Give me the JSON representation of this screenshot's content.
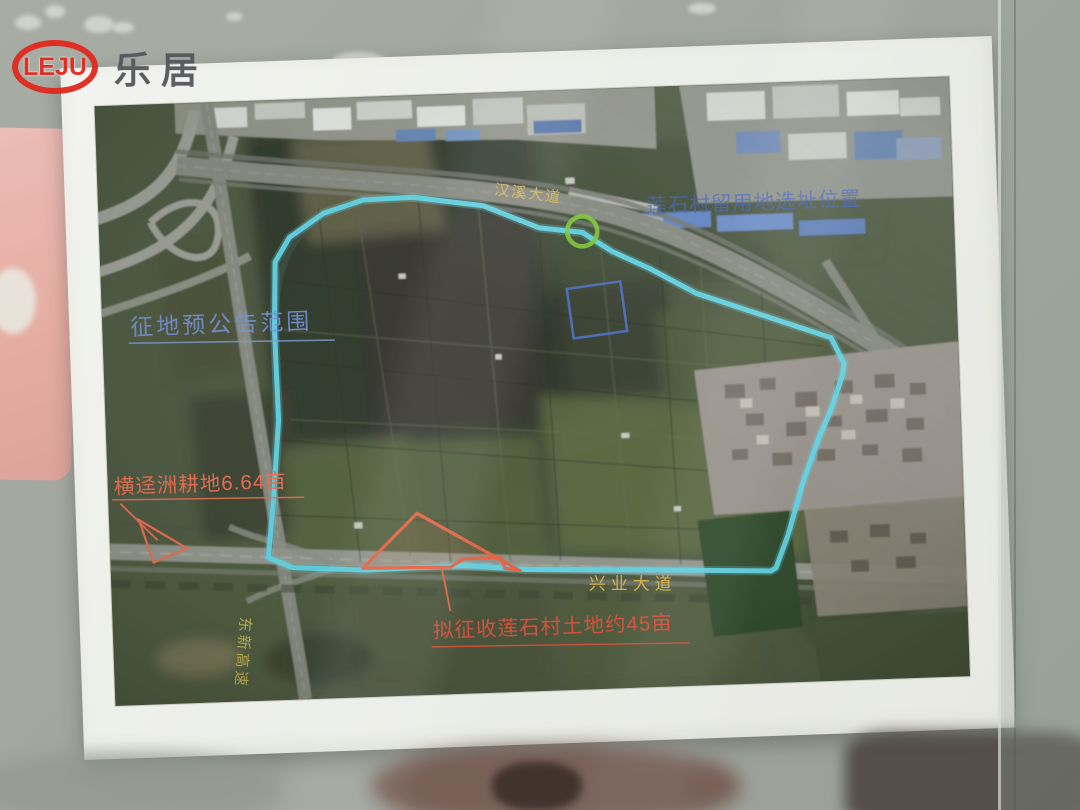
{
  "logo": {
    "mark": "LEJU",
    "name": "乐居"
  },
  "annotations": {
    "boundary": {
      "label": "征地预公告范围",
      "line_color": "#5ed8ea",
      "label_color": "#7290d8"
    },
    "site": {
      "label": "莲石村留用地选址位置",
      "label_color": "#3a5cc8"
    },
    "plot": {
      "label": "横迳洲耕地6.64亩",
      "label_color": "#ea6a4c"
    },
    "acquisition": {
      "label": "拟征收莲石村土地约45亩",
      "label_color": "#dc4c34"
    },
    "highlight_circle_color": "#7cc832",
    "highlight_square_color": "#4a6fd0"
  },
  "roads": {
    "top": "汉溪大道",
    "bottom": "兴业大道",
    "left": "东新高速",
    "label_color": "#e0b448"
  }
}
